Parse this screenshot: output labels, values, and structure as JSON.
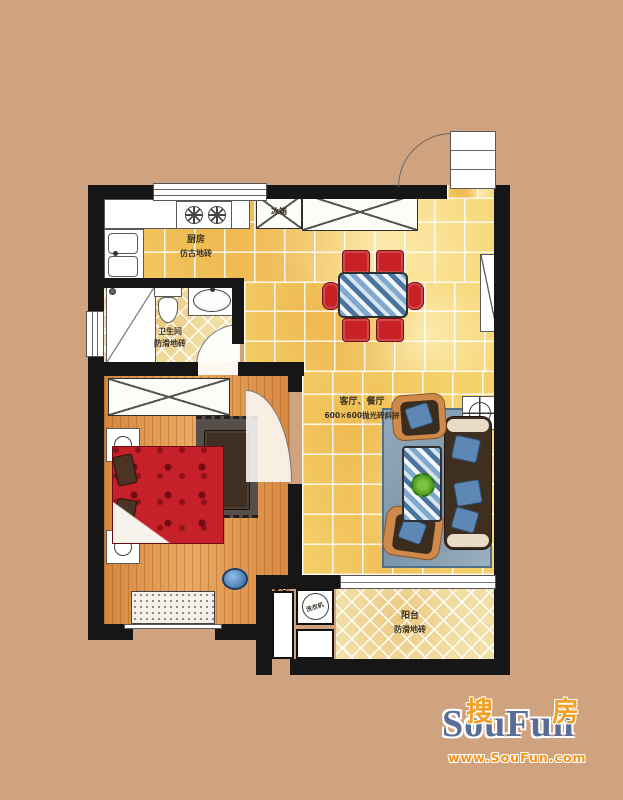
{
  "background": {
    "color": "#cfa37f"
  },
  "plan": {
    "rooms": {
      "kitchen": {
        "name": "厨房",
        "floor_note": "仿古地砖"
      },
      "living_dining": {
        "name": "客厅、餐厅",
        "floor_note": "600×600抛光砖斜拼"
      },
      "bathroom": {
        "name": "卫生间",
        "floor_note": "防滑地砖"
      },
      "balcony": {
        "name": "阳台",
        "floor_note": "防滑地砖"
      }
    },
    "appliances": {
      "fridge": "冰箱",
      "washer": "洗衣机"
    },
    "colors": {
      "wall": "#161616",
      "floor_tile": "#f5d26b",
      "wood_floor": "#e2994f",
      "bed_red": "#c6202a",
      "chair_red": "#c82227",
      "furniture_brown": "#40301f",
      "accent_blue": "#5d87b4",
      "rug_blue": "#8ba3b6"
    }
  },
  "watermark": {
    "zh_first": "搜",
    "zh_second": "房",
    "brand": "SouFun",
    "url": "www.SouFun.com",
    "brand_color": "#5a6d96",
    "accent_color": "#f09a20"
  }
}
